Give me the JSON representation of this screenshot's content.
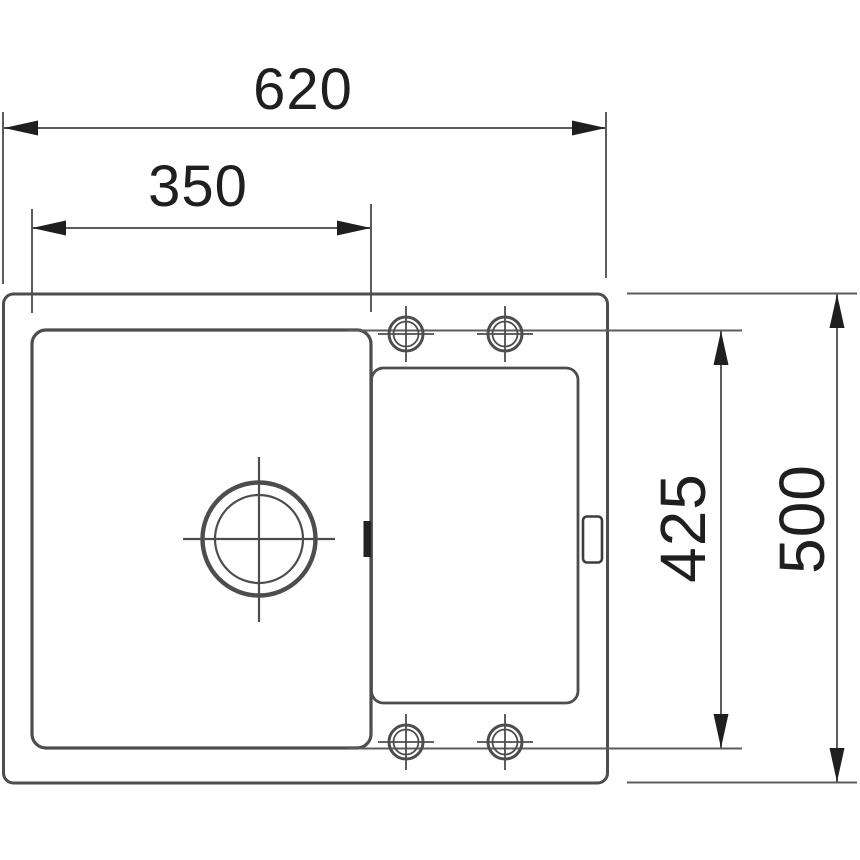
{
  "drawing": {
    "type": "sink-top-view-technical-drawing",
    "dimensions": {
      "overall_width": {
        "label": "620"
      },
      "bowl_width": {
        "label": "350"
      },
      "bowl_depth": {
        "label": "425"
      },
      "overall_depth": {
        "label": "500"
      }
    }
  },
  "colors": {
    "object_line": "#4d4d4d",
    "dimension_line": "#5c5c5c",
    "text_and_arrows": "#1f1f1f",
    "background": "#ffffff"
  }
}
